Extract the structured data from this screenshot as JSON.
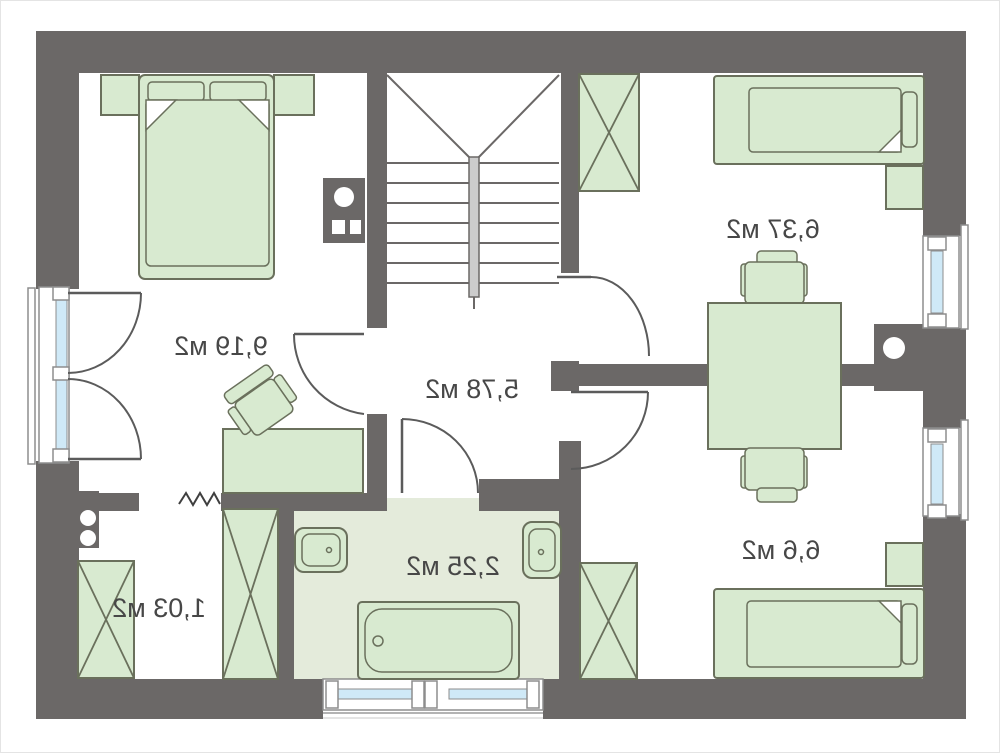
{
  "document": {
    "kind": "floor-plan-drawing",
    "mirrored_text": true,
    "area_unit": "м2"
  },
  "colors": {
    "wall": "#6b6867",
    "furniture_fill": "#d8ead0",
    "furniture_stroke": "#6a705c",
    "bathroom_floor": "#e4ebdb",
    "window_glass": "#cfe9f7",
    "label_text": "#474747"
  },
  "rooms": [
    {
      "name": "bedroom-left",
      "area_label": "9,19 м2"
    },
    {
      "name": "hall-with-stairs",
      "area_label": "5,78 м2"
    },
    {
      "name": "room-top-right",
      "area_label": "6,37 м2"
    },
    {
      "name": "room-bottom-right",
      "area_label": "6,6 м2"
    },
    {
      "name": "storage-bottom-left",
      "area_label": "1,03 м2"
    },
    {
      "name": "bathroom",
      "area_label": "2,25 м2"
    }
  ],
  "fixtures": [
    "double-bed",
    "nightstand",
    "desk",
    "chair",
    "wardrobe",
    "staircase",
    "handrail",
    "bathtub",
    "sink",
    "radiator",
    "chimney",
    "window",
    "door-swing"
  ]
}
